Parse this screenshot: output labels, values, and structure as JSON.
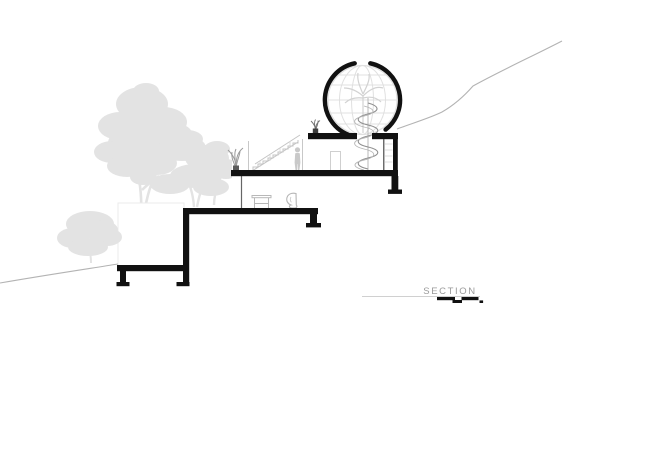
{
  "label": {
    "text": "SECTION"
  },
  "colors": {
    "ink": "#111111",
    "vegetation": "#e3e3e3",
    "terrain": "#b3b3b3",
    "label_text": "#9b9b9b",
    "wireframe": "#e0e0e0",
    "detail": "#c4c4c4",
    "detail_dark": "#8f8f8f"
  },
  "scale_bar": {
    "top_segments": 2,
    "bottom_segments": 2
  }
}
